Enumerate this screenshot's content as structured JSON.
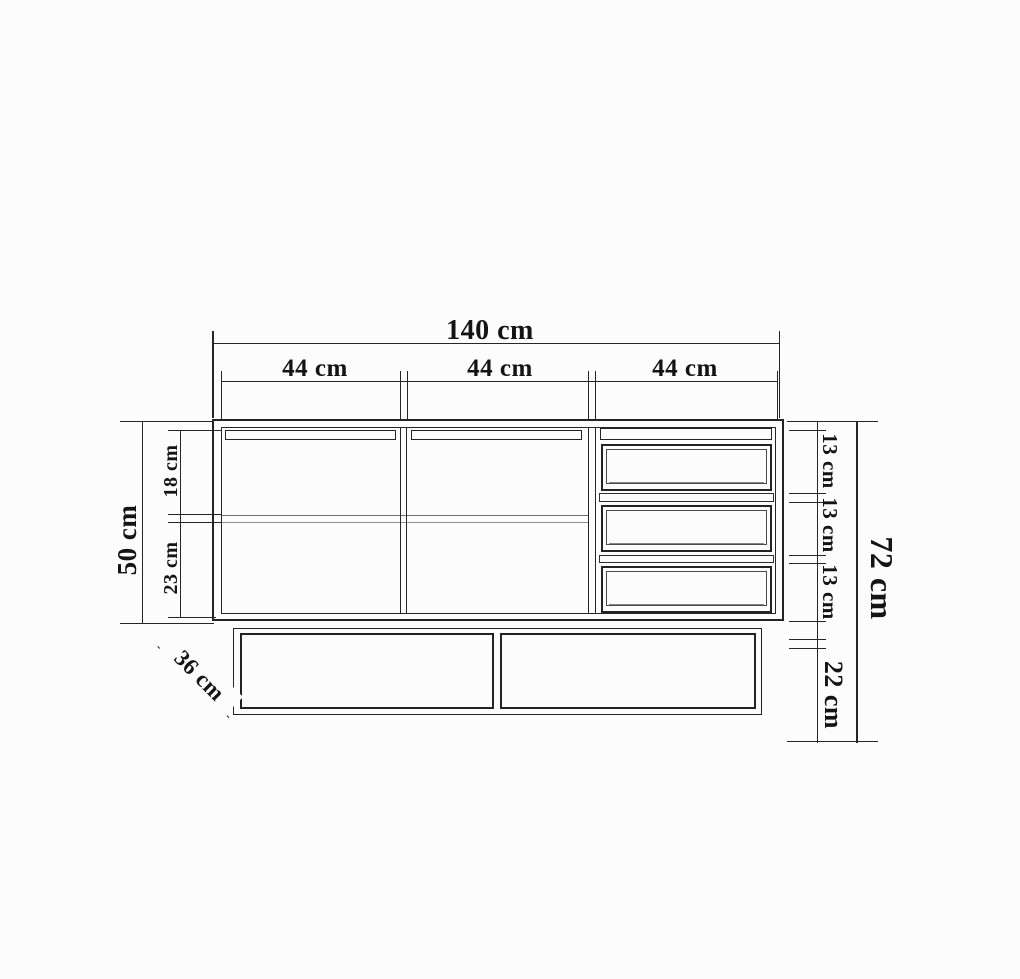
{
  "dimensions": {
    "total_width": "140 cm",
    "sections": [
      "44 cm",
      "44 cm",
      "44 cm"
    ],
    "upper_height": "50 cm",
    "upper_compartment": "18 cm",
    "lower_compartment": "23 cm",
    "depth": "36 cm",
    "drawers": [
      "13 cm",
      "13 cm",
      "13 cm"
    ],
    "base_height": "22 cm",
    "total_height": "72 cm"
  },
  "colors": {
    "background": "#fcfcfc",
    "line": "#262626",
    "shelf_line": "#8f8f8f"
  }
}
